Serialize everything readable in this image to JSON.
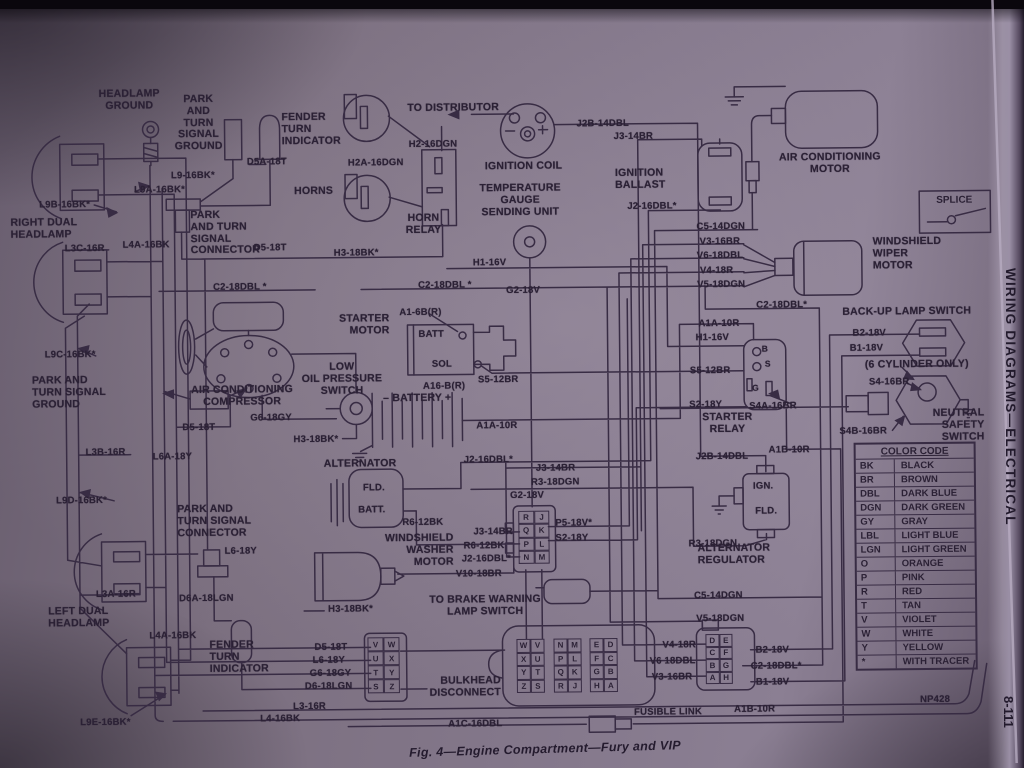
{
  "page": {
    "figure_caption": "Fig. 4—Engine Compartment—Fury and VIP",
    "sidebar_title": "WIRING DIAGRAMS—ELECTRICAL",
    "page_number": "8-111",
    "splice_label": "SPLICE"
  },
  "color_code": {
    "title": "COLOR CODE",
    "rows": [
      [
        "BK",
        "BLACK"
      ],
      [
        "BR",
        "BROWN"
      ],
      [
        "DBL",
        "DARK BLUE"
      ],
      [
        "DGN",
        "DARK GREEN"
      ],
      [
        "GY",
        "GRAY"
      ],
      [
        "LBL",
        "LIGHT BLUE"
      ],
      [
        "LGN",
        "LIGHT GREEN"
      ],
      [
        "O",
        "ORANGE"
      ],
      [
        "P",
        "PINK"
      ],
      [
        "R",
        "RED"
      ],
      [
        "T",
        "TAN"
      ],
      [
        "V",
        "VIOLET"
      ],
      [
        "W",
        "WHITE"
      ],
      [
        "Y",
        "YELLOW"
      ],
      [
        "*",
        "WITH TRACER"
      ]
    ]
  },
  "grids": {
    "connector_left": {
      "rows": [
        [
          "V",
          "W"
        ],
        [
          "U",
          "X"
        ],
        [
          "T",
          "Y"
        ],
        [
          "S",
          "Z"
        ]
      ]
    },
    "bulkhead_a": {
      "rows": [
        [
          "W",
          "V"
        ],
        [
          "X",
          "U"
        ],
        [
          "Y",
          "T"
        ],
        [
          "Z",
          "S"
        ]
      ]
    },
    "bulkhead_b": {
      "rows": [
        [
          "N",
          "M"
        ],
        [
          "P",
          "L"
        ],
        [
          "Q",
          "K"
        ],
        [
          "R",
          "J"
        ]
      ]
    },
    "bulkhead_c": {
      "rows": [
        [
          "E",
          "D"
        ],
        [
          "F",
          "C"
        ],
        [
          "G",
          "B"
        ],
        [
          "H",
          "A"
        ]
      ]
    },
    "connector_center": {
      "rows": [
        [
          "R",
          "J"
        ],
        [
          "Q",
          "K"
        ],
        [
          "P",
          "L"
        ],
        [
          "N",
          "M"
        ]
      ]
    },
    "connector_right": {
      "rows": [
        [
          "D",
          "E"
        ],
        [
          "C",
          "F"
        ],
        [
          "B",
          "G"
        ],
        [
          "A",
          "H"
        ]
      ]
    }
  },
  "component_labels": [
    {
      "n": "headlamp-ground",
      "t": "HEADLAMP\nGROUND",
      "x": 88,
      "y": 85,
      "w": 88,
      "a": "center"
    },
    {
      "n": "park-turn-signal-ground-top",
      "t": "PARK\nAND\nTURN\nSIGNAL\nGROUND",
      "x": 170,
      "y": 91,
      "w": 62,
      "a": "center"
    },
    {
      "n": "fender-turn-indicator-top",
      "t": "FENDER\nTURN\nINDICATOR",
      "x": 284,
      "y": 110,
      "w": 72,
      "a": "left"
    },
    {
      "n": "right-dual-headlamp",
      "t": "RIGHT DUAL\nHEADLAMP",
      "x": 12,
      "y": 213,
      "w": 82,
      "a": "left"
    },
    {
      "n": "horns",
      "t": "HORNS",
      "x": 296,
      "y": 184,
      "w": 50,
      "a": "left"
    },
    {
      "n": "horn-relay",
      "t": "HORN\nRELAY",
      "x": 400,
      "y": 212,
      "w": 50,
      "a": "center"
    },
    {
      "n": "to-distributor",
      "t": "TO DISTRIBUTOR",
      "x": 410,
      "y": 102,
      "w": 112,
      "a": "left"
    },
    {
      "n": "ignition-coil",
      "t": "IGNITION COIL",
      "x": 487,
      "y": 161,
      "w": 100,
      "a": "left"
    },
    {
      "n": "temperature-gauge-sending-unit",
      "t": "TEMPERATURE\nGAUGE\nSENDING UNIT",
      "x": 468,
      "y": 183,
      "w": 108,
      "a": "center"
    },
    {
      "n": "ignition-ballast",
      "t": "IGNITION\nBALLAST",
      "x": 617,
      "y": 169,
      "w": 70,
      "a": "left"
    },
    {
      "n": "air-conditioning-motor",
      "t": "AIR CONDITIONING\nMOTOR",
      "x": 762,
      "y": 155,
      "w": 140,
      "a": "center"
    },
    {
      "n": "windshield-wiper-motor",
      "t": "WINDSHIELD\nWIPER\nMOTOR",
      "x": 874,
      "y": 240,
      "w": 90,
      "a": "left"
    },
    {
      "n": "back-up-lamp-switch",
      "t": "BACK-UP LAMP SWITCH",
      "x": 843,
      "y": 310,
      "w": 155,
      "a": "left"
    },
    {
      "n": "six-cylinder-only",
      "t": "(6 CYLINDER ONLY)",
      "x": 865,
      "y": 363,
      "w": 128,
      "a": "left"
    },
    {
      "n": "neutral-safety-switch",
      "t": "NEUTRAL SAFETY\nSWITCH",
      "x": 888,
      "y": 412,
      "w": 96,
      "a": "right"
    },
    {
      "n": "starter-relay",
      "t": "STARTER\nRELAY",
      "x": 698,
      "y": 414,
      "w": 58,
      "a": "center"
    },
    {
      "n": "starter-motor",
      "t": "STARTER\nMOTOR",
      "x": 328,
      "y": 312,
      "w": 62,
      "a": "right"
    },
    {
      "n": "low-oil-pressure-switch",
      "t": "LOW\nOIL PRESSURE\nSWITCH",
      "x": 294,
      "y": 360,
      "w": 96,
      "a": "center"
    },
    {
      "n": "battery",
      "t": "– BATTERY +",
      "x": 383,
      "y": 392,
      "w": 86,
      "a": "left"
    },
    {
      "n": "air-conditioning-compressor",
      "t": "AIR CONDITIONING\nCOMPRESSOR",
      "x": 172,
      "y": 382,
      "w": 140,
      "a": "center"
    },
    {
      "n": "park-turn-signal-ground-left",
      "t": "PARK AND\nTURN SIGNAL\nGROUND",
      "x": 32,
      "y": 371,
      "w": 94,
      "a": "left"
    },
    {
      "n": "alternator",
      "t": "ALTERNATOR",
      "x": 323,
      "y": 457,
      "w": 92,
      "a": "left"
    },
    {
      "n": "windshield-washer-motor",
      "t": "WINDSHIELD\nWASHER\nMOTOR",
      "x": 368,
      "y": 532,
      "w": 84,
      "a": "right"
    },
    {
      "n": "to-brake-warning-lamp-switch",
      "t": "TO BRAKE WARNING\nLAMP SWITCH",
      "x": 425,
      "y": 594,
      "w": 116,
      "a": "center"
    },
    {
      "n": "alternator-regulator",
      "t": "ALTERNATOR\nREGULATOR",
      "x": 696,
      "y": 545,
      "w": 94,
      "a": "left"
    },
    {
      "n": "park-turn-signal-connector-top",
      "t": "PARK\nAND TURN\nSIGNAL\nCONNECTOR",
      "x": 192,
      "y": 207,
      "w": 82,
      "a": "left"
    },
    {
      "n": "park-turn-signal-connector-left",
      "t": "PARK AND\nTURN SIGNAL\nCONNECTOR",
      "x": 176,
      "y": 501,
      "w": 96,
      "a": "left"
    },
    {
      "n": "left-dual-headlamp",
      "t": "LEFT DUAL\nHEADLAMP",
      "x": 46,
      "y": 602,
      "w": 82,
      "a": "left"
    },
    {
      "n": "fender-turn-indicator-bottom",
      "t": "FENDER\nTURN\nINDICATOR",
      "x": 207,
      "y": 637,
      "w": 78,
      "a": "left"
    },
    {
      "n": "bulkhead-disconnect",
      "t": "BULKHEAD\nDISCONNECT",
      "x": 426,
      "y": 675,
      "w": 72,
      "a": "right"
    }
  ],
  "wire_labels": [
    {
      "t": "D5A-18T",
      "x": 249,
      "y": 154
    },
    {
      "t": "L9-16BK*",
      "x": 173,
      "y": 167
    },
    {
      "t": "L9A-16BK*",
      "x": 136,
      "y": 181
    },
    {
      "t": "L9B-16BK*",
      "x": 41,
      "y": 195
    },
    {
      "t": "L3C-16R",
      "x": 66,
      "y": 239
    },
    {
      "t": "L4A-16BK",
      "x": 124,
      "y": 236
    },
    {
      "t": "H2A-16DGN",
      "x": 350,
      "y": 156
    },
    {
      "t": "H2-16DGN",
      "x": 411,
      "y": 138
    },
    {
      "t": "J2B-14DBL",
      "x": 579,
      "y": 119
    },
    {
      "t": "J3-14BR",
      "x": 616,
      "y": 132
    },
    {
      "t": "J2-16DBL*",
      "x": 629,
      "y": 202
    },
    {
      "t": "C5-14DGN",
      "x": 698,
      "y": 223
    },
    {
      "t": "V3-16BR",
      "x": 701,
      "y": 238
    },
    {
      "t": "V6-18DBL",
      "x": 698,
      "y": 252
    },
    {
      "t": "V4-18R",
      "x": 701,
      "y": 267
    },
    {
      "t": "V5-18DGN",
      "x": 698,
      "y": 281
    },
    {
      "t": "C2-18DBL *",
      "x": 214,
      "y": 279
    },
    {
      "t": "C2-18DBL *",
      "x": 419,
      "y": 279
    },
    {
      "t": "D5-18T",
      "x": 255,
      "y": 240
    },
    {
      "t": "H3-18BK*",
      "x": 335,
      "y": 246
    },
    {
      "t": "H1-16V",
      "x": 474,
      "y": 257
    },
    {
      "t": "G2-18V",
      "x": 507,
      "y": 285
    },
    {
      "t": "A1A-10R",
      "x": 699,
      "y": 320
    },
    {
      "t": "H1-16V",
      "x": 696,
      "y": 334
    },
    {
      "t": "C2-18DBL*",
      "x": 757,
      "y": 302
    },
    {
      "t": "S5-12BR",
      "x": 690,
      "y": 367
    },
    {
      "t": "S2-18Y",
      "x": 689,
      "y": 401
    },
    {
      "t": "S4A-16BR",
      "x": 749,
      "y": 403
    },
    {
      "t": "B2-18V",
      "x": 853,
      "y": 331
    },
    {
      "t": "B1-18V",
      "x": 850,
      "y": 346
    },
    {
      "t": "S4-16BR",
      "x": 869,
      "y": 380
    },
    {
      "t": "S4B-16BR",
      "x": 839,
      "y": 429
    },
    {
      "t": "A1B-10R",
      "x": 768,
      "y": 447
    },
    {
      "t": "J2B-14DBL",
      "x": 695,
      "y": 453
    },
    {
      "t": "A1-6B(R)",
      "x": 400,
      "y": 306
    },
    {
      "t": "BATT",
      "x": 419,
      "y": 328
    },
    {
      "t": "SOL",
      "x": 432,
      "y": 358
    },
    {
      "t": "S5-12BR",
      "x": 478,
      "y": 374
    },
    {
      "t": "A16-B(R)",
      "x": 423,
      "y": 380
    },
    {
      "t": "A1A-10R",
      "x": 476,
      "y": 420
    },
    {
      "t": "L9C-16BK*",
      "x": 45,
      "y": 345
    },
    {
      "t": "D5-18T",
      "x": 182,
      "y": 419
    },
    {
      "t": "G6-18GY",
      "x": 250,
      "y": 410
    },
    {
      "t": "H3-18BK*",
      "x": 293,
      "y": 432
    },
    {
      "t": "L3B-16R",
      "x": 85,
      "y": 443
    },
    {
      "t": "L6A-18Y",
      "x": 152,
      "y": 448
    },
    {
      "t": "L9D-16BK*",
      "x": 55,
      "y": 491
    },
    {
      "t": "FLD.",
      "x": 362,
      "y": 481
    },
    {
      "t": "BATT.",
      "x": 357,
      "y": 503
    },
    {
      "t": "R6-12BK",
      "x": 401,
      "y": 516
    },
    {
      "t": "J2-16DBL*",
      "x": 463,
      "y": 454
    },
    {
      "t": "J3-14BR",
      "x": 535,
      "y": 463
    },
    {
      "t": "R3-18DGN",
      "x": 530,
      "y": 477
    },
    {
      "t": "G2-18V",
      "x": 509,
      "y": 490
    },
    {
      "t": "J3-14BR",
      "x": 472,
      "y": 526
    },
    {
      "t": "R6-12BK",
      "x": 462,
      "y": 540
    },
    {
      "t": "J2-16DBL*",
      "x": 460,
      "y": 553
    },
    {
      "t": "V10-18BR",
      "x": 454,
      "y": 568
    },
    {
      "t": "P5-18V*",
      "x": 554,
      "y": 518
    },
    {
      "t": "S2-18Y",
      "x": 554,
      "y": 533
    },
    {
      "t": "IGN.",
      "x": 752,
      "y": 483
    },
    {
      "t": "FLD.",
      "x": 754,
      "y": 508
    },
    {
      "t": "R3-18DGN",
      "x": 687,
      "y": 540
    },
    {
      "t": "H3-18BK*",
      "x": 326,
      "y": 602
    },
    {
      "t": "C5-14DGN",
      "x": 692,
      "y": 592
    },
    {
      "t": "V5-18DGN",
      "x": 694,
      "y": 615
    },
    {
      "t": "L6-18Y",
      "x": 223,
      "y": 543
    },
    {
      "t": "D6A-18LGN",
      "x": 177,
      "y": 590
    },
    {
      "t": "L3A-16R",
      "x": 94,
      "y": 585
    },
    {
      "t": "L4A-16BK",
      "x": 147,
      "y": 627
    },
    {
      "t": "L9E-16BK*",
      "x": 77,
      "y": 713
    },
    {
      "t": "D5-18T",
      "x": 312,
      "y": 640
    },
    {
      "t": "L6-18Y",
      "x": 310,
      "y": 653
    },
    {
      "t": "G6-18GY",
      "x": 307,
      "y": 666
    },
    {
      "t": "D6-18LGN",
      "x": 302,
      "y": 679
    },
    {
      "t": "L3-16R",
      "x": 290,
      "y": 699
    },
    {
      "t": "L4-16BK",
      "x": 257,
      "y": 711
    },
    {
      "t": "A1C-16DBL",
      "x": 445,
      "y": 718
    },
    {
      "t": "V4-18R",
      "x": 660,
      "y": 641
    },
    {
      "t": "V6 18DBL",
      "x": 647,
      "y": 657
    },
    {
      "t": "V3-16BR",
      "x": 649,
      "y": 673
    },
    {
      "t": "B2-18V",
      "x": 753,
      "y": 647
    },
    {
      "t": "C2-18DBL*",
      "x": 748,
      "y": 663
    },
    {
      "t": "B1-18V",
      "x": 753,
      "y": 679
    },
    {
      "t": "FUSIBLE LINK",
      "x": 631,
      "y": 708
    },
    {
      "t": "A1B-10R",
      "x": 731,
      "y": 706
    },
    {
      "t": "NP428",
      "n": "plate-code",
      "x": 917,
      "y": 698
    },
    {
      "t": "B",
      "n": "terminal-letter",
      "x": 762,
      "y": 346,
      "s": 8.5
    },
    {
      "t": "S",
      "n": "terminal-letter",
      "x": 765,
      "y": 361,
      "s": 8.5
    },
    {
      "t": "G",
      "n": "terminal-letter",
      "x": 752,
      "y": 385,
      "s": 8.5
    }
  ]
}
